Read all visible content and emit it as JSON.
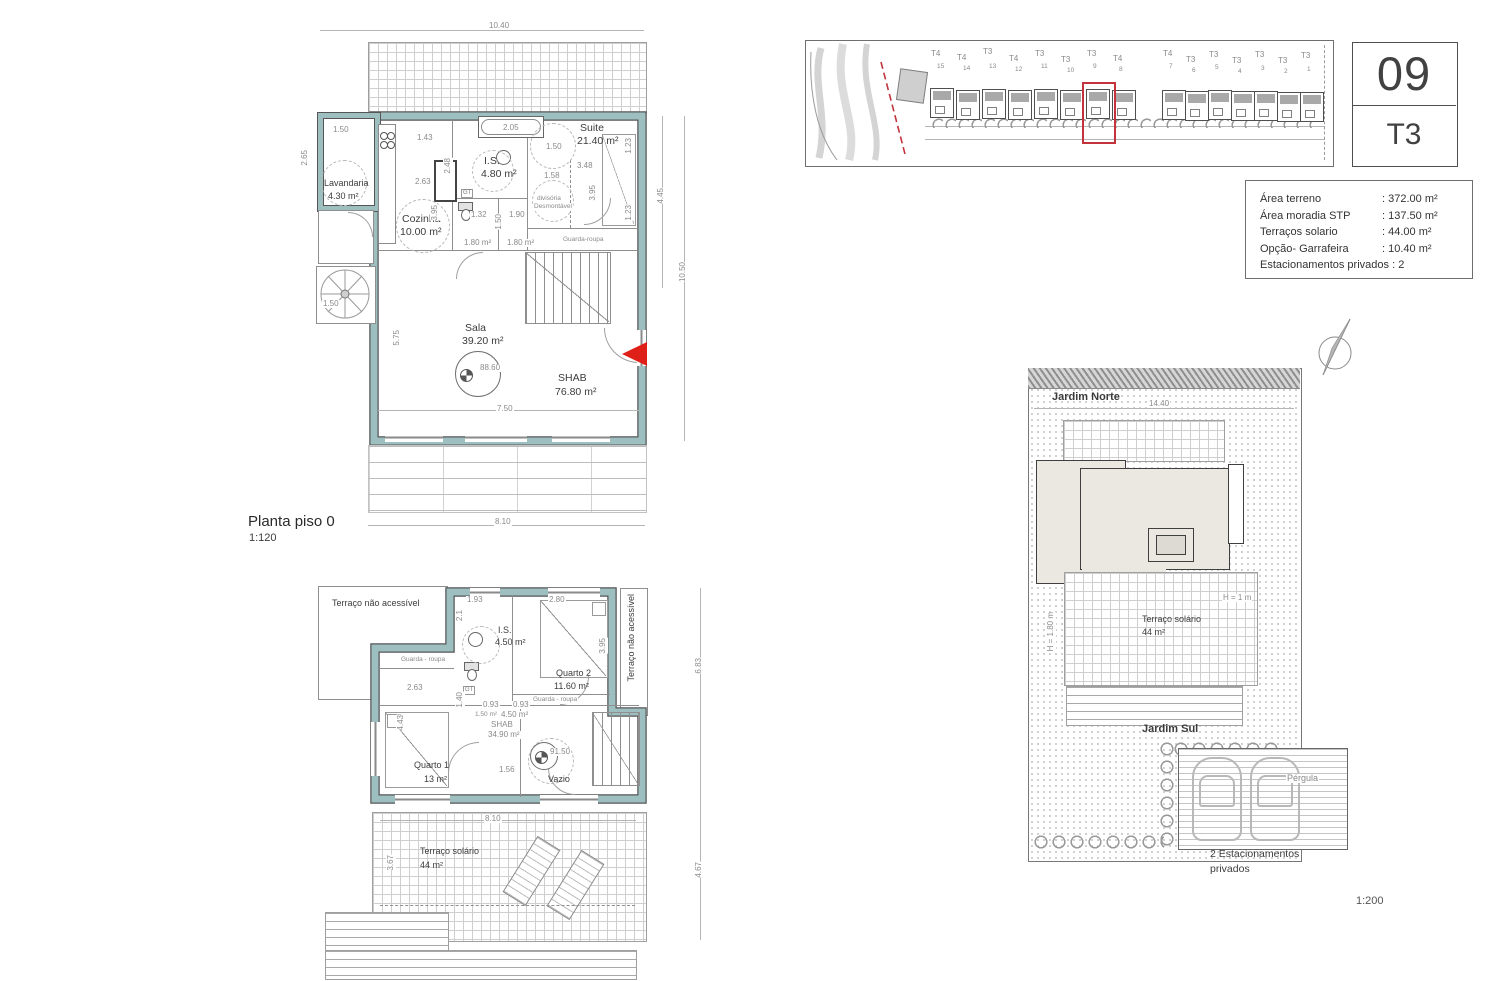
{
  "sheet": {
    "unit_number": "09",
    "typology": "T3"
  },
  "info_table": {
    "rows": [
      {
        "label": "Área terreno",
        "value": "372.00 m²"
      },
      {
        "label": "Área moradia STP",
        "value": "137.50 m²"
      },
      {
        "label": "Terraços solario",
        "value": "44.00 m²"
      },
      {
        "label": "Opção- Garrafeira",
        "value": "10.40 m²"
      },
      {
        "label": "Estacionamentos privados",
        "value": "2"
      }
    ]
  },
  "site_plan": {
    "lots": [
      {
        "t": "T4",
        "n": "15"
      },
      {
        "t": "T4",
        "n": "14"
      },
      {
        "t": "T3",
        "n": "13"
      },
      {
        "t": "T4",
        "n": "12"
      },
      {
        "t": "T3",
        "n": "11"
      },
      {
        "t": "T3",
        "n": "10"
      },
      {
        "t": "T3",
        "n": "9"
      },
      {
        "t": "T4",
        "n": "8"
      },
      {
        "t": "T4",
        "n": "7"
      },
      {
        "t": "T3",
        "n": "6"
      },
      {
        "t": "T3",
        "n": "5"
      },
      {
        "t": "T3",
        "n": "4"
      },
      {
        "t": "T3",
        "n": "3"
      },
      {
        "t": "T3",
        "n": "2"
      },
      {
        "t": "T3",
        "n": "1"
      }
    ]
  },
  "plan0": {
    "title": "Planta piso 0",
    "scale": "1:120",
    "level": "88.60",
    "gt": "GT",
    "rooms": {
      "lavandaria": {
        "name": "Lavandaria",
        "area": "4.30 m²"
      },
      "cozinha": {
        "name": "Cozinha",
        "area": "10.00 m²"
      },
      "is": {
        "name": "I.S.",
        "area": "4.80 m²"
      },
      "suite": {
        "name": "Suite",
        "area": "21.40 m²"
      },
      "sala": {
        "name": "Sala",
        "area": "39.20 m²"
      },
      "shab": {
        "name": "SHAB",
        "area": "76.80 m²"
      },
      "hall1": {
        "area": "1.80 m²"
      },
      "hall2": {
        "area": "1.80 m²"
      },
      "divisoria": {
        "line1": "divisória",
        "line2": "Desmontável"
      },
      "guarda": "Guarda-roupa"
    },
    "dims": {
      "w_total": "10.40",
      "lav_w": "1.50",
      "lav_h": "2.65",
      "spiral": "1.50",
      "k1": "1.43",
      "k2": "2.63",
      "k3": "2.48",
      "k4": "3.95",
      "tub": "2.05",
      "s_w": "1.50",
      "s1": "3.48",
      "s2": "1.58",
      "s3": "3.95",
      "r1": "1.23",
      "r2": "1.23",
      "right_in": "4.45",
      "right_out": "10.50",
      "e1": "1.32",
      "e2": "1.90",
      "e3": "1.50",
      "sala_h": "5.75",
      "sala_w": "7.50",
      "w_bottom": "8.10"
    }
  },
  "plan1": {
    "level": "91.50",
    "gt": "GT",
    "rooms": {
      "terrace_na": "Terraço não acessível",
      "terrace_na2": "Terraço não acessível",
      "is": {
        "name": "I.S.",
        "area": "4.50 m²"
      },
      "quarto2": {
        "name": "Quarto 2",
        "area": "11.60 m²"
      },
      "quarto1": {
        "name": "Quarto 1",
        "area": "13 m²"
      },
      "shab": {
        "name": "SHAB",
        "area": "34.90 m²"
      },
      "vazio": "Vazio",
      "guarda1": "Guarda - roupa",
      "guarda2": "Guarda - roupa",
      "small1": "1.50 m²",
      "small2": "4.50 m²",
      "terraco": {
        "name": "Terraço solário",
        "area": "44 m²"
      }
    },
    "dims": {
      "t1": "1.93",
      "t2": "2.80",
      "is_h": "2.1",
      "q2_h": "3.95",
      "q1_w": "2.63",
      "q1_h": "4.43",
      "c1": "0.93",
      "c2": "0.93",
      "c3": "1.40",
      "c4": "1.56",
      "right_top": "6.83",
      "right_bottom": "4.67",
      "ter_w": "8.10",
      "ter_h": "3.67"
    }
  },
  "garden": {
    "north_label": "Jardim Norte",
    "width": "14.40",
    "h_wall": "H = 1.80 m",
    "h_wall2": "H = 1 m",
    "terraco": {
      "name": "Terraço solário",
      "area": "44 m²"
    },
    "south_label": "Jardim Sul",
    "pergola": "Pérgula",
    "parking_line1": "2 Estacionamentos",
    "parking_line2": "privados",
    "scale": "1:200"
  }
}
